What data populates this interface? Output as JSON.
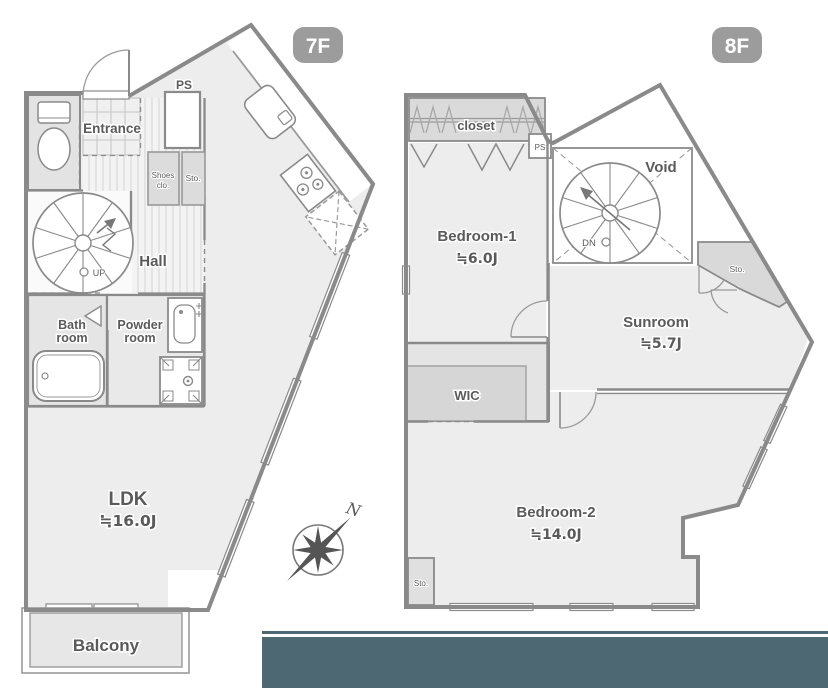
{
  "colors": {
    "accent_bar": "#4d6872",
    "badge": "#9c9c9c",
    "wall": "#8a8a8a",
    "floor": "#ededed"
  },
  "floor7": {
    "badge": "7F",
    "labels": {
      "ps": "PS",
      "entrance": "Entrance",
      "shoes_l1": "Shoes",
      "shoes_l2": "clo.",
      "storage": "Sto.",
      "hall": "Hall",
      "up": "UP",
      "bath_l1": "Bath",
      "bath_l2": "room",
      "powder_l1": "Powder",
      "powder_l2": "room",
      "ldk": "LDK",
      "ldk_size": "≒16.0J",
      "balcony": "Balcony"
    }
  },
  "floor8": {
    "badge": "8F",
    "labels": {
      "closet": "closet",
      "ps": "PS",
      "bedroom1": "Bedroom-1",
      "bedroom1_size": "≒6.0J",
      "void": "Void",
      "dn": "DN",
      "storage_upper": "Sto.",
      "sunroom": "Sunroom",
      "sunroom_size": "≒5.7J",
      "wic": "WIC",
      "bedroom2": "Bedroom-2",
      "bedroom2_size": "≒14.0J",
      "storage_lower": "Sto."
    }
  },
  "compass": {
    "north": "N"
  }
}
